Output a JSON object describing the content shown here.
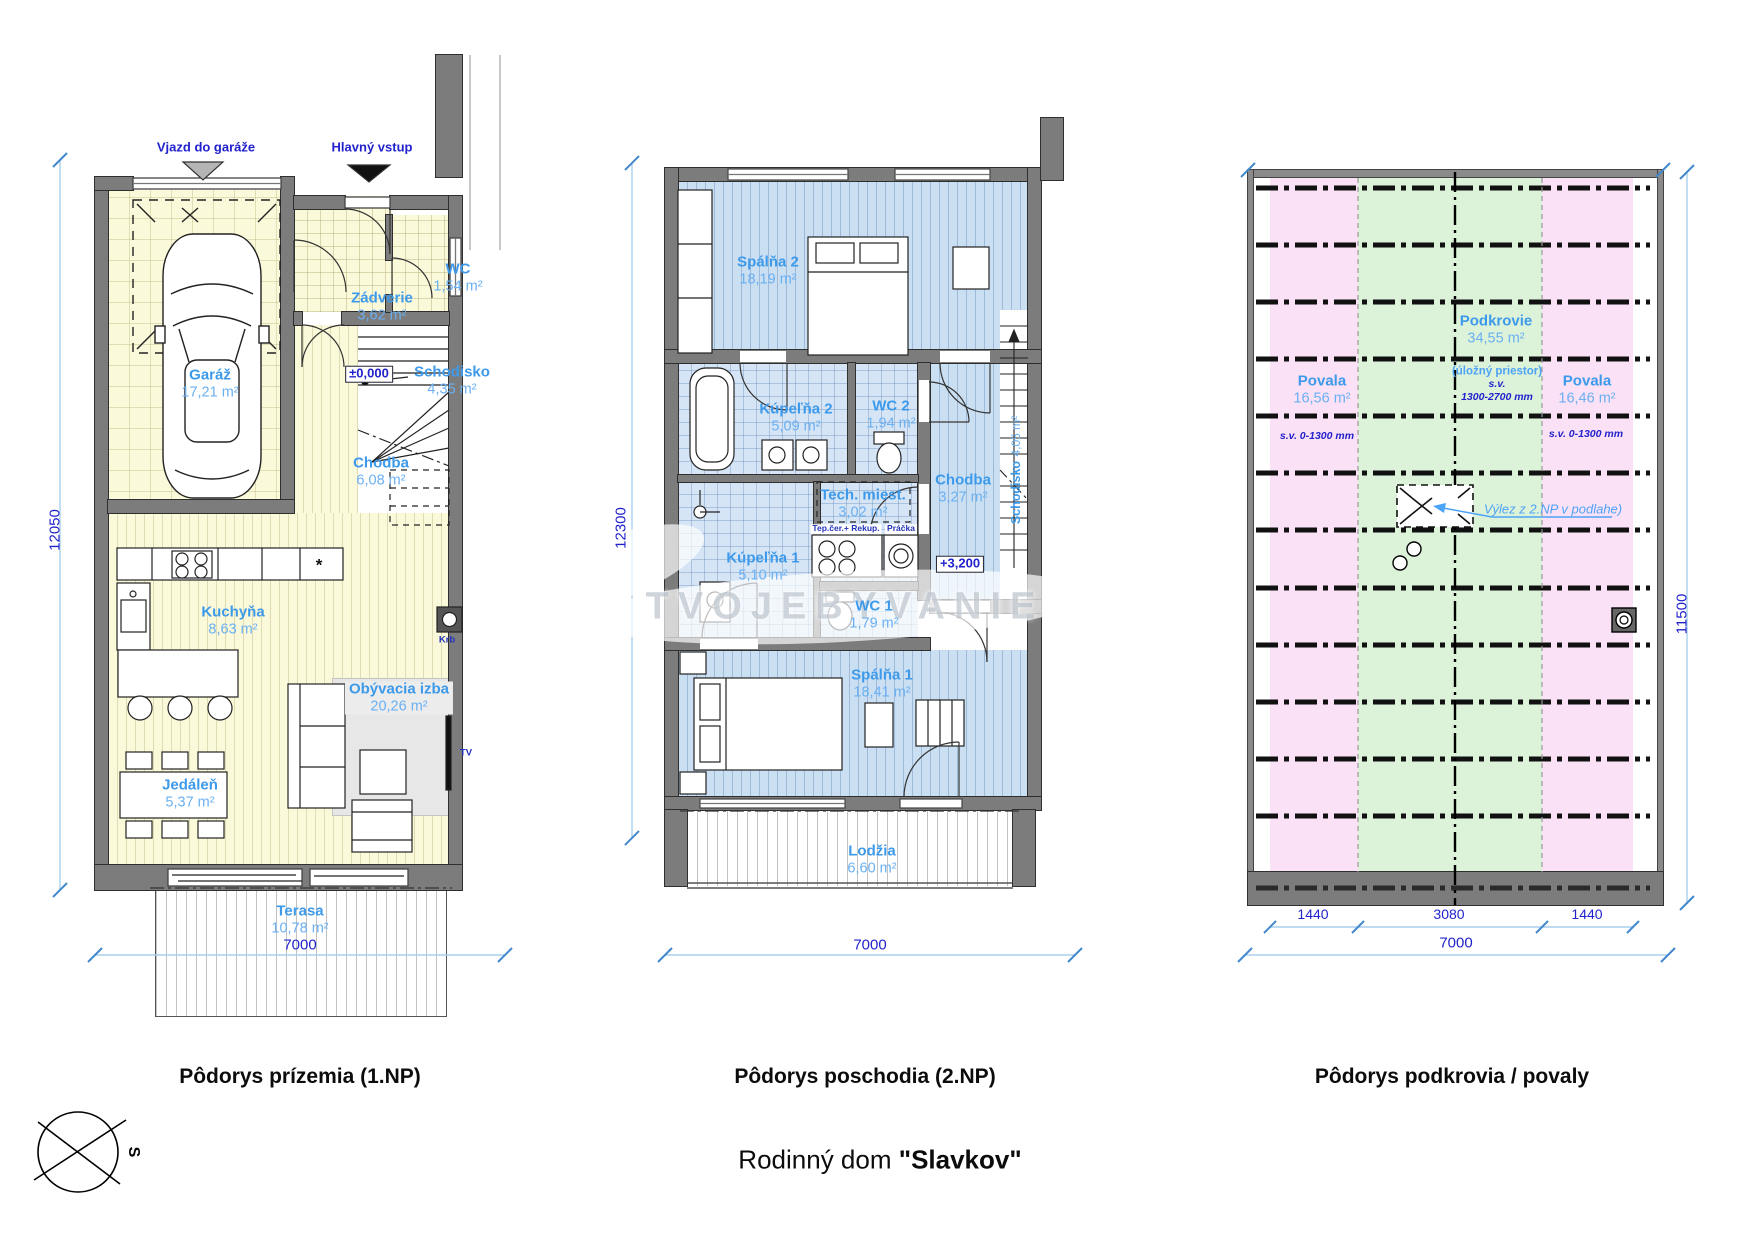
{
  "plan1": {
    "title": "Pôdorys prízemia (1.NP)",
    "annotations": {
      "garage_entry": "Vjazd do garáže",
      "main_entry": "Hlavný vstup",
      "level": "±0,000",
      "fireplace": "Krb",
      "tv": "TV",
      "star": "*"
    },
    "rooms": {
      "garaz": {
        "name": "Garáž",
        "area": "17,21 m²"
      },
      "zadverie": {
        "name": "Zádverie",
        "area": "3,62 m²"
      },
      "wc": {
        "name": "WC",
        "area": "1,54 m²"
      },
      "schodisko": {
        "name": "Schodisko",
        "area": "4,35 m²"
      },
      "chodba": {
        "name": "Chodba",
        "area": "6,08 m²"
      },
      "kuchyna": {
        "name": "Kuchyňa",
        "area": "8,63 m²"
      },
      "jedalen": {
        "name": "Jedáleň",
        "area": "5,37 m²"
      },
      "obyvacia": {
        "name": "Obývacia izba",
        "area": "20,26 m²"
      },
      "terasa": {
        "name": "Terasa",
        "area": "10,78 m²"
      }
    },
    "dimensions": {
      "width": "7000",
      "height": "12050"
    }
  },
  "plan2": {
    "title": "Pôdorys poschodia (2.NP)",
    "annotations": {
      "level": "+3,200",
      "heatpump": "Tep.čer.+ Rekup.",
      "washer": "Práčka"
    },
    "rooms": {
      "spalna2": {
        "name": "Spálňa 2",
        "area": "18,19 m²"
      },
      "kupelna2": {
        "name": "Kúpeľňa 2",
        "area": "5,09 m²"
      },
      "wc2": {
        "name": "WC 2",
        "area": "1,94 m²"
      },
      "tech": {
        "name": "Tech. miest.",
        "area": "3,02 m²"
      },
      "chodba": {
        "name": "Chodba",
        "area": "3,27 m²"
      },
      "schodisko": {
        "name": "Schodisko",
        "area": "4,05 m²"
      },
      "kupelna1": {
        "name": "Kúpeľňa 1",
        "area": "5,10 m²"
      },
      "wc1": {
        "name": "WC 1",
        "area": "1,79 m²"
      },
      "spalna1": {
        "name": "Spálňa 1",
        "area": "18,41 m²"
      },
      "lodzia": {
        "name": "Lodžia",
        "area": "6,60 m²"
      }
    },
    "dimensions": {
      "width": "7000",
      "height": "12300"
    }
  },
  "plan3": {
    "title": "Pôdorys podkrovia / povaly",
    "zones": {
      "povala_left": {
        "name": "Povala",
        "area": "16,56 m²",
        "clearance": "s.v. 0-1300 mm"
      },
      "podkrovie": {
        "name": "Podkrovie",
        "area": "34,55 m²",
        "note": "(úložný priestor)",
        "clearance_label": "s.v.",
        "clearance": "1300-2700 mm"
      },
      "povala_right": {
        "name": "Povala",
        "area": "16,46 m²",
        "clearance": "s.v. 0-1300 mm"
      }
    },
    "annotations": {
      "hatch": "Výlez z 2.NP v podlahe)"
    },
    "dimensions": {
      "seg1": "1440",
      "seg2": "3080",
      "seg3": "1440",
      "width": "7000",
      "height": "11500"
    }
  },
  "footer": {
    "main_title_prefix": "Rodinný dom",
    "main_title_name": "\"Slavkov\""
  },
  "compass": {
    "north": "S"
  },
  "watermark": {
    "text": "TVOJEBYVANIE"
  },
  "colors": {
    "room_label_blue": "#3D9AEA",
    "room_area_blue": "#6AB0F2",
    "dimension_blue": "#2222CC",
    "wall_gray": "#7C7C7C",
    "floor_cream": "#FAF9DA",
    "floor_blue": "#CBDFF2",
    "attic_pink": "#FAE1F6",
    "attic_green": "#DCF3DA"
  }
}
